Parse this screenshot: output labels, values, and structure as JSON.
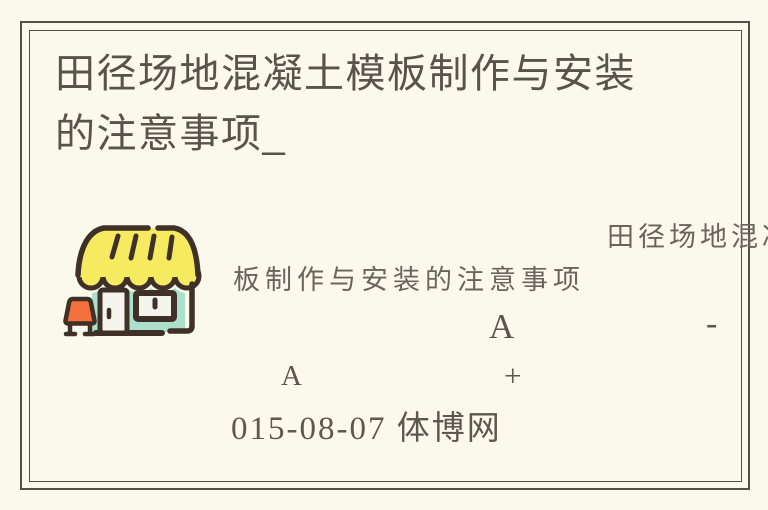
{
  "page": {
    "background_color": "#FBF9EC",
    "frame_color": "#525047"
  },
  "title": {
    "full_text": "田径场地混凝土模板制作与安装的注意事项_",
    "line1": "田径场地混凝土模板制作与安装",
    "line2": "的注意事项_"
  },
  "watermark": {
    "line1": "田径场地混凝",
    "line2": "板制作与安装的注意事项"
  },
  "font_controls": {
    "decrease_letter": "A",
    "decrease_sign": "-",
    "increase_letter": "A",
    "increase_sign": "+"
  },
  "meta": {
    "date_source": "015-08-07 体博网"
  },
  "icon": {
    "name": "storefront-icon",
    "colors": {
      "awning_yellow": "#F6EB60",
      "wall_teal": "#ACDFCC",
      "door_white": "#F5F4ED",
      "sign_orange": "#F4703D",
      "outline_brown": "#3F3028"
    }
  }
}
